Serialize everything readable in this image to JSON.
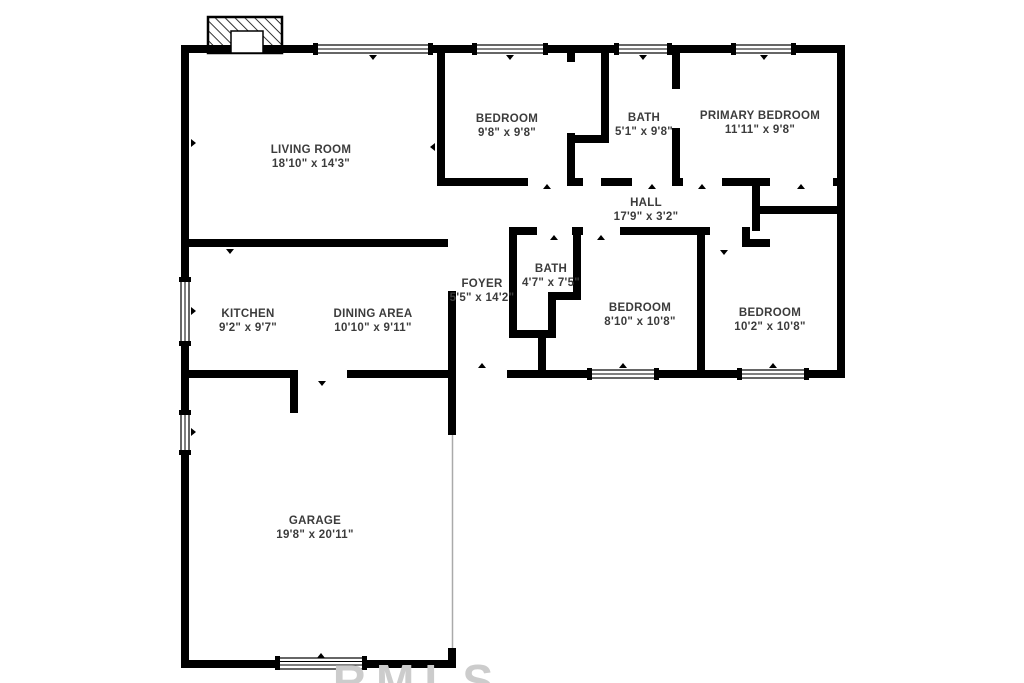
{
  "document": {
    "type": "residential-floor-plan",
    "colors": {
      "wall": "#000000",
      "room_text": "#3c3c3c",
      "watermark": "#cccccc",
      "background": "#ffffff"
    }
  },
  "rooms": [
    {
      "id": "living-room",
      "name": "LIVING ROOM",
      "dims": "18'10\" x 14'3\""
    },
    {
      "id": "bedroom-1",
      "name": "BEDROOM",
      "dims": "9'8\" x 9'8\""
    },
    {
      "id": "bath-1",
      "name": "BATH",
      "dims": "5'1\" x 9'8\""
    },
    {
      "id": "primary-bedroom",
      "name": "PRIMARY BEDROOM",
      "dims": "11'11\" x 9'8\""
    },
    {
      "id": "hall",
      "name": "HALL",
      "dims": "17'9\" x 3'2\""
    },
    {
      "id": "foyer",
      "name": "FOYER",
      "dims": "5'5\" x 14'2\""
    },
    {
      "id": "bath-2",
      "name": "BATH",
      "dims": "4'7\" x 7'5\""
    },
    {
      "id": "bedroom-2",
      "name": "BEDROOM",
      "dims": "8'10\" x 10'8\""
    },
    {
      "id": "bedroom-3",
      "name": "BEDROOM",
      "dims": "10'2\" x 10'8\""
    },
    {
      "id": "kitchen",
      "name": "KITCHEN",
      "dims": "9'2\" x 9'7\""
    },
    {
      "id": "dining-area",
      "name": "DINING AREA",
      "dims": "10'10\" x 9'11\""
    },
    {
      "id": "garage",
      "name": "GARAGE",
      "dims": "19'8\" x 20'11\""
    }
  ],
  "watermark": {
    "text": "RMLS"
  }
}
